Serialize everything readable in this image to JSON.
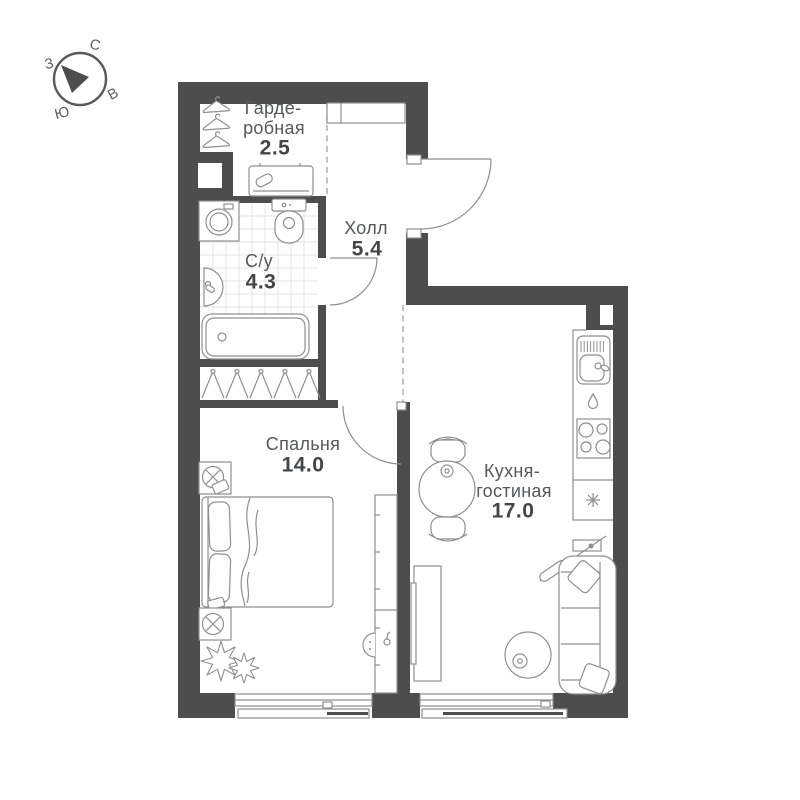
{
  "plan": {
    "title": "Апартаменты — план этажа",
    "compass": {
      "north": "С",
      "east": "В",
      "south": "Ю",
      "west": "З"
    },
    "rooms": [
      {
        "id": "wardrobe",
        "name_lines": [
          "Гарде-",
          "робная"
        ],
        "area": "2.5"
      },
      {
        "id": "hall",
        "name_lines": [
          "Холл"
        ],
        "area": "5.4"
      },
      {
        "id": "bathroom",
        "name_lines": [
          "С/у"
        ],
        "area": "4.3"
      },
      {
        "id": "bedroom",
        "name_lines": [
          "Спальня"
        ],
        "area": "14.0"
      },
      {
        "id": "kitchen-living",
        "name_lines": [
          "Кухня-",
          "гостиная"
        ],
        "area": "17.0"
      }
    ],
    "colors": {
      "wall": "#4d4d4d",
      "furniture_stroke": "#8f8f8f",
      "room_name_text": "#54585b",
      "area_text": "#424649",
      "tile_line": "#e4e4e4",
      "dashed_line": "#b3b3b3"
    }
  }
}
